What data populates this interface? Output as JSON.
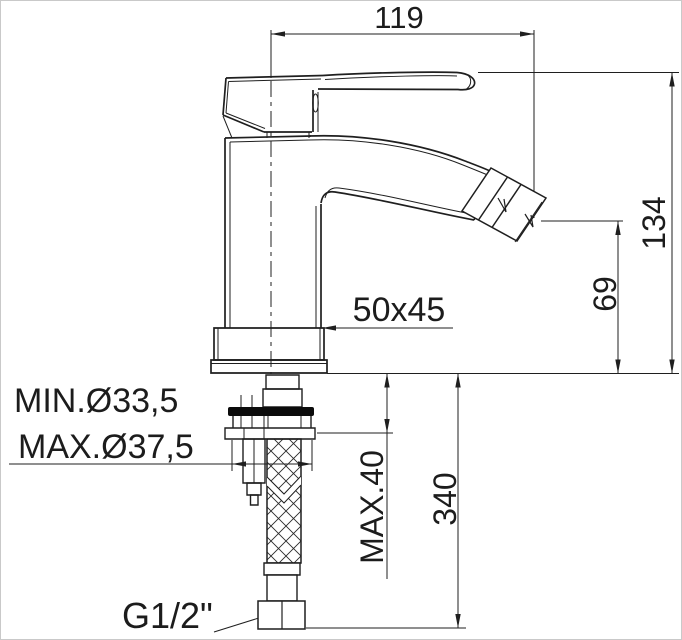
{
  "drawing": {
    "labels": {
      "spout_reach": "119",
      "overall_height": "134",
      "outlet_height": "69",
      "base_footprint": "50x45",
      "hole_min": "MIN.Ø33,5",
      "hole_max": "MAX.Ø37,5",
      "max_deck_thickness": "MAX.40",
      "hose_length": "340",
      "thread": "G1/2\""
    },
    "colors": {
      "line": "#1f1f1f",
      "background": "#ffffff",
      "seal_ring": "#0b0b0b"
    }
  }
}
